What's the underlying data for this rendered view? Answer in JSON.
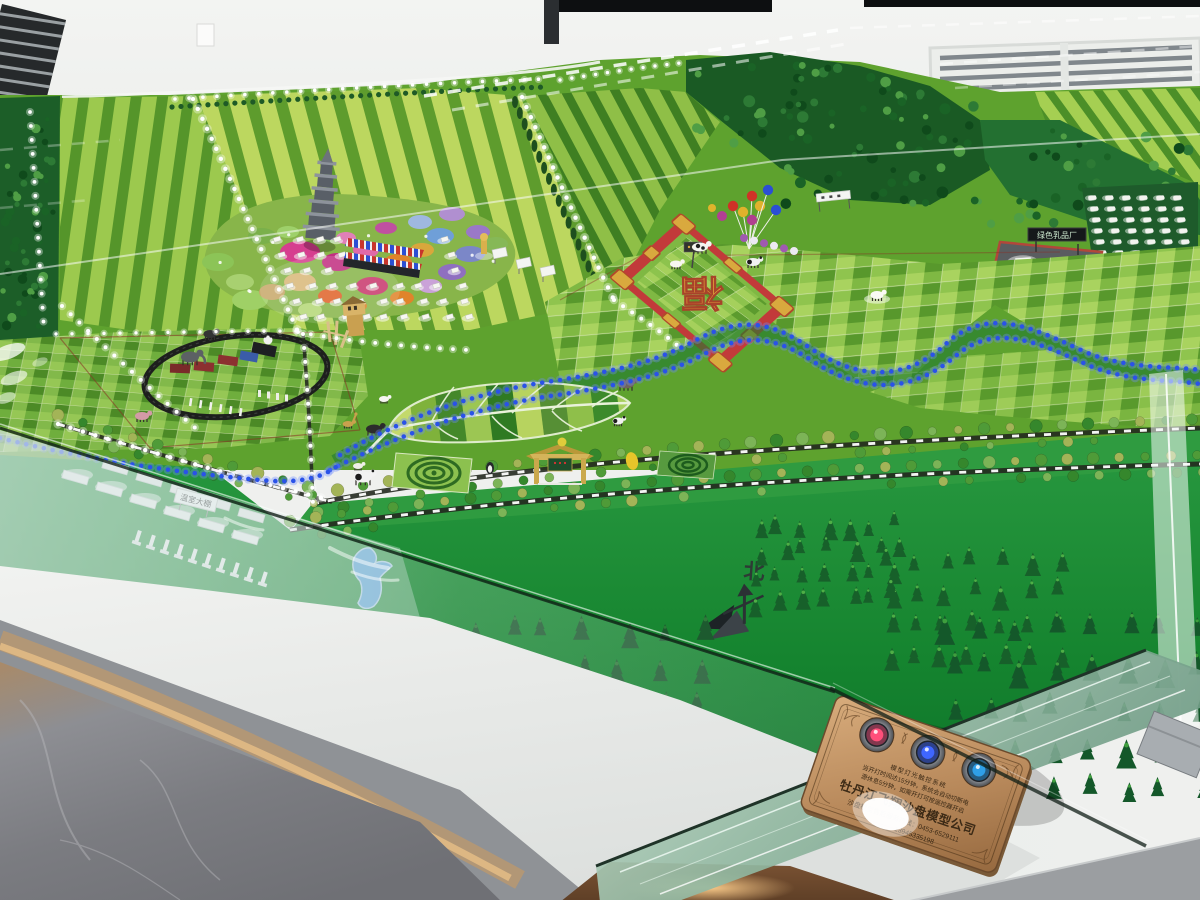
{
  "labels": {
    "north_marker": "北",
    "fortune_character": "福",
    "greenhouse_sign": "温室大棚",
    "dairy_sign": "绿色乳品厂"
  },
  "plaque": {
    "system_title": "模型灯光触控系统",
    "notice_line1": "当开灯时间达15分钟，系统会自动切断电",
    "notice_line2": "源休息5分钟，如需开灯可按遥控器开启",
    "company_name": "牡丹江飞翔沙盘模型公司",
    "hotline": "沙盘模型售后服务热线：0453-6529111",
    "phone": "13945335198",
    "buttons": [
      {
        "name": "power-button-red",
        "glow_color": "#ff4f7a"
      },
      {
        "name": "power-button-blue-1",
        "glow_color": "#3f66ff"
      },
      {
        "name": "power-button-blue-2",
        "glow_color": "#2f9fe8"
      }
    ]
  },
  "colors": {
    "field_light_green": "#9cc94e",
    "field_dark_green": "#4e8f23",
    "lawn_green": "#1f8f37",
    "forest_green": "#1a5a24",
    "river_led_blue": "#2a52e8",
    "path_led_white": "#ffffff",
    "diamond_red": "#c23a3a",
    "diamond_gold": "#d9a93e",
    "plaque_copper": "#b8895b",
    "wall_white": "#eff0ee",
    "floor_gray": "#77787d",
    "glass_green": "#8fb79f"
  }
}
